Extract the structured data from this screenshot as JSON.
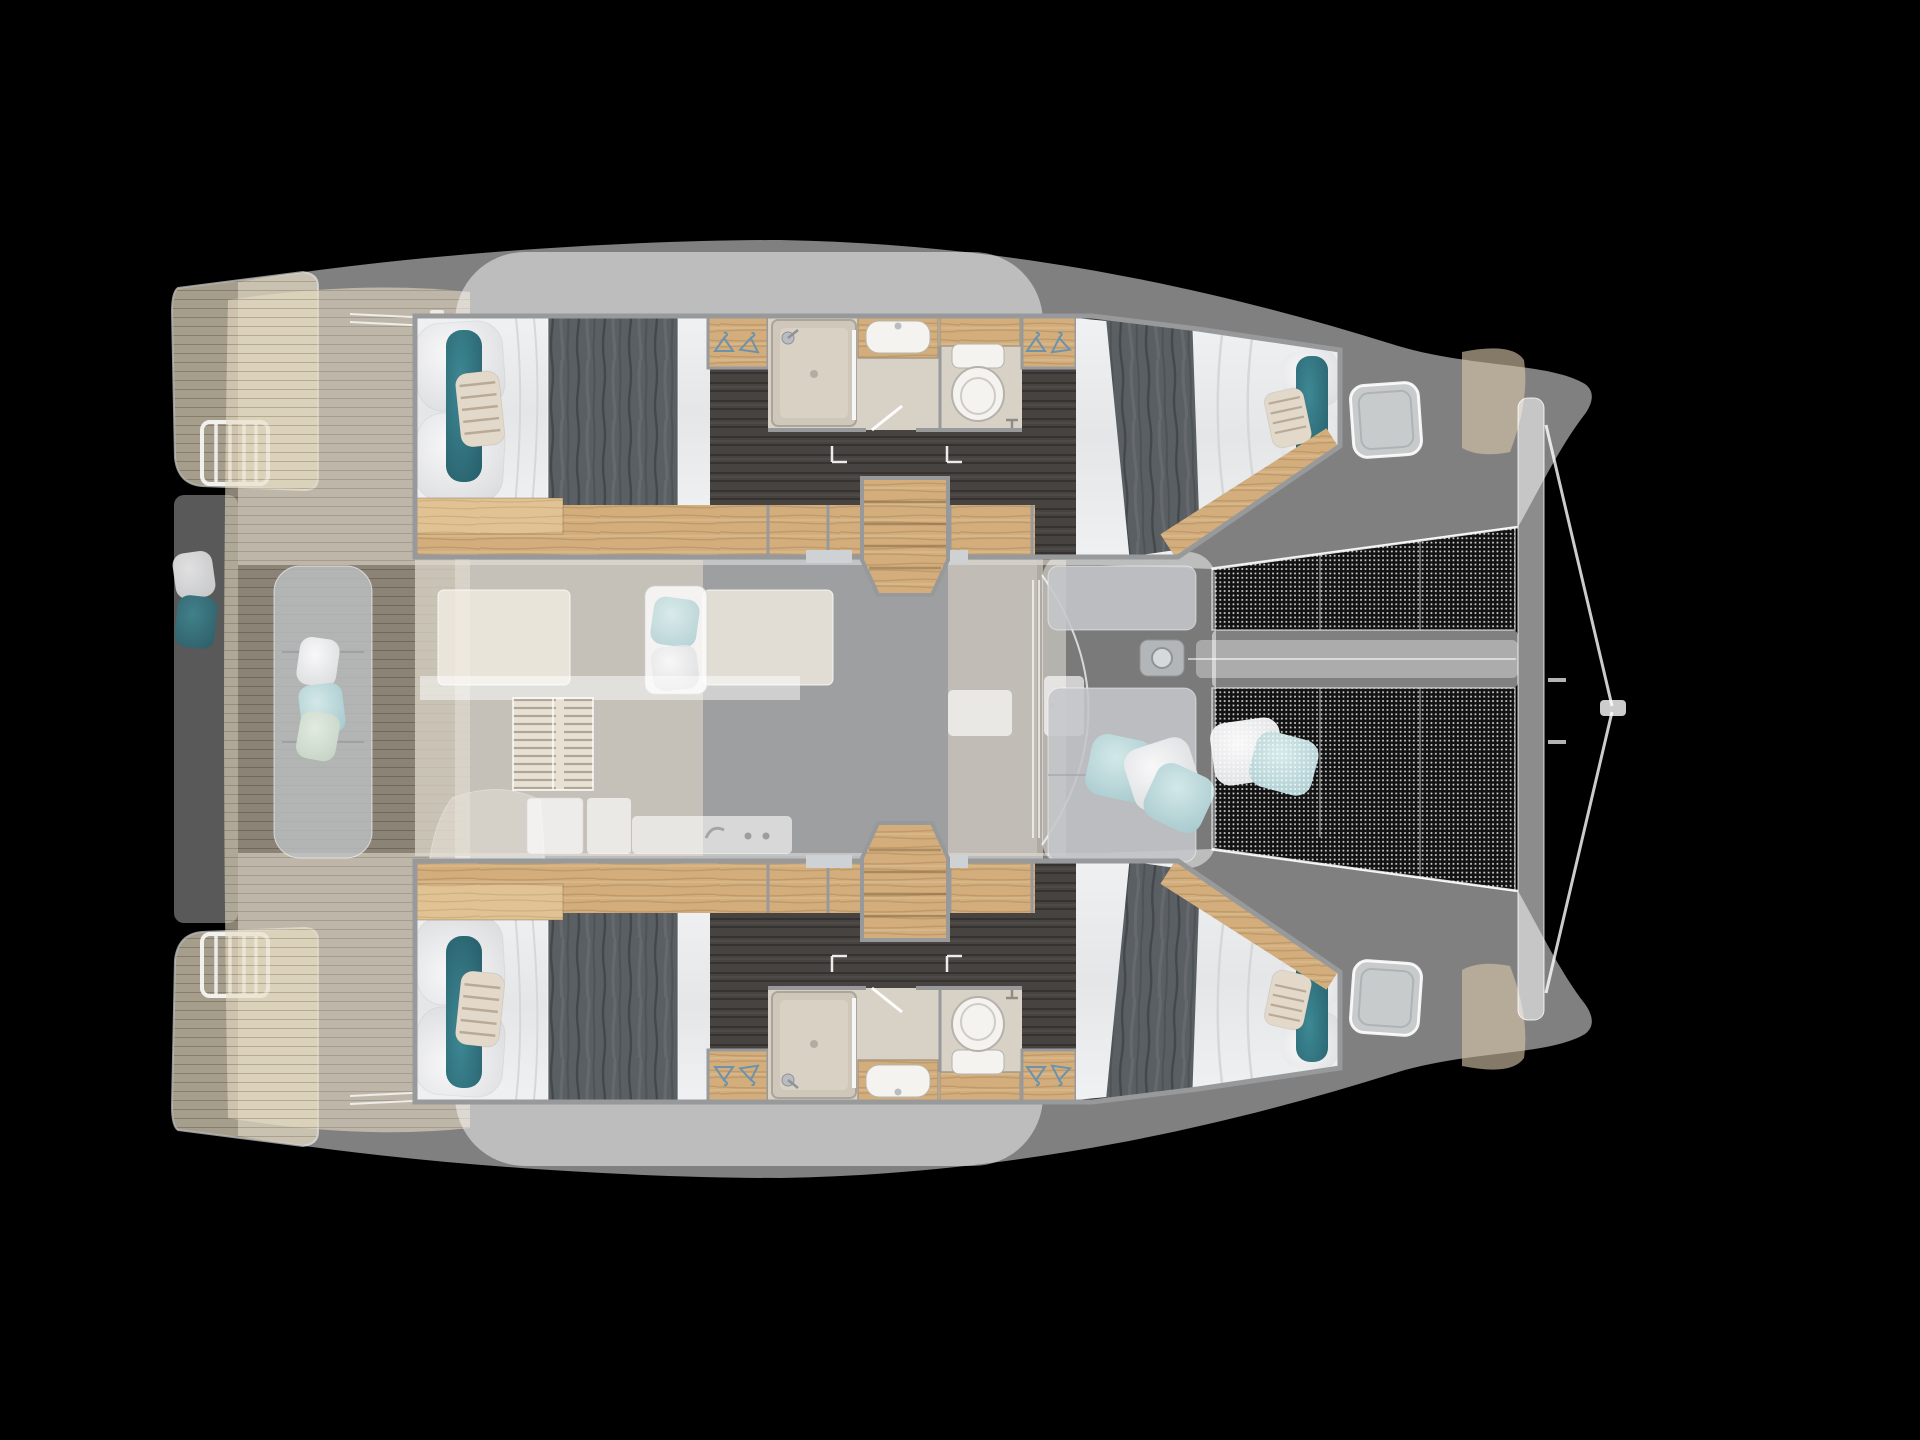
{
  "meta": {
    "title": "Catamaran 4-cabin / 2-head layout — top view floor plan",
    "type": "boat-floor-plan",
    "orientation": "bow-right"
  },
  "counts": {
    "cabins": 4,
    "bathrooms": 2,
    "wardrobes": 4,
    "companionway_steps": 2,
    "trampolines": 2,
    "deck_hatches": 2,
    "swim_ladders": 2
  },
  "colors": {
    "background": "#000000",
    "ghost-deck": "#ffffff",
    "teak": "#e7dcc4",
    "teak-line": "#968052",
    "wood": "#d3ae7c",
    "wood-light": "#e0c293",
    "dark-floor": "#474341",
    "duvet": "#5a5f63",
    "mattress": "#eceef0",
    "teal-pillow": "#2f7480",
    "striped-pillow": "#e3d9cb",
    "blue-pillow": "#bcd9dc",
    "green-pillow": "#d3e0d2",
    "bath-floor": "#d8d1c6",
    "fixture-white": "#f4f3f0",
    "chrome": "#b9bdc1",
    "pad-gray": "#c4c6c9",
    "hanger-blue": "#6c92ad",
    "border-gray": "#98999b"
  },
  "regions": {
    "stern": [
      "aft-swim-platform-port",
      "aft-swim-platform-starboard",
      "swim-ladder",
      "transom-seat",
      "cockpit-teak-deck",
      "cockpit-bench"
    ],
    "hulls": [
      "aft-cabin-double-bed",
      "hanging-wardrobe",
      "bathroom-shower",
      "bathroom-sink",
      "bathroom-toilet",
      "corridor",
      "forward-cabin-double-bed",
      "companionway-steps"
    ],
    "salon_ghost": [
      "dining-table",
      "settee",
      "chaise-with-pillows",
      "louvered-hatch",
      "galley-sink",
      "galley-stove",
      "nav-cabinets",
      "sliding-door"
    ],
    "foredeck": [
      "lounge-pad-port",
      "lounge-pad-starboard",
      "scatter-pillows",
      "anchor-windlass",
      "deck-hatch",
      "bow-teak-pad"
    ],
    "bow": [
      "trampoline-port",
      "trampoline-starboard",
      "forward-crossbeam",
      "bridle-lines"
    ]
  }
}
